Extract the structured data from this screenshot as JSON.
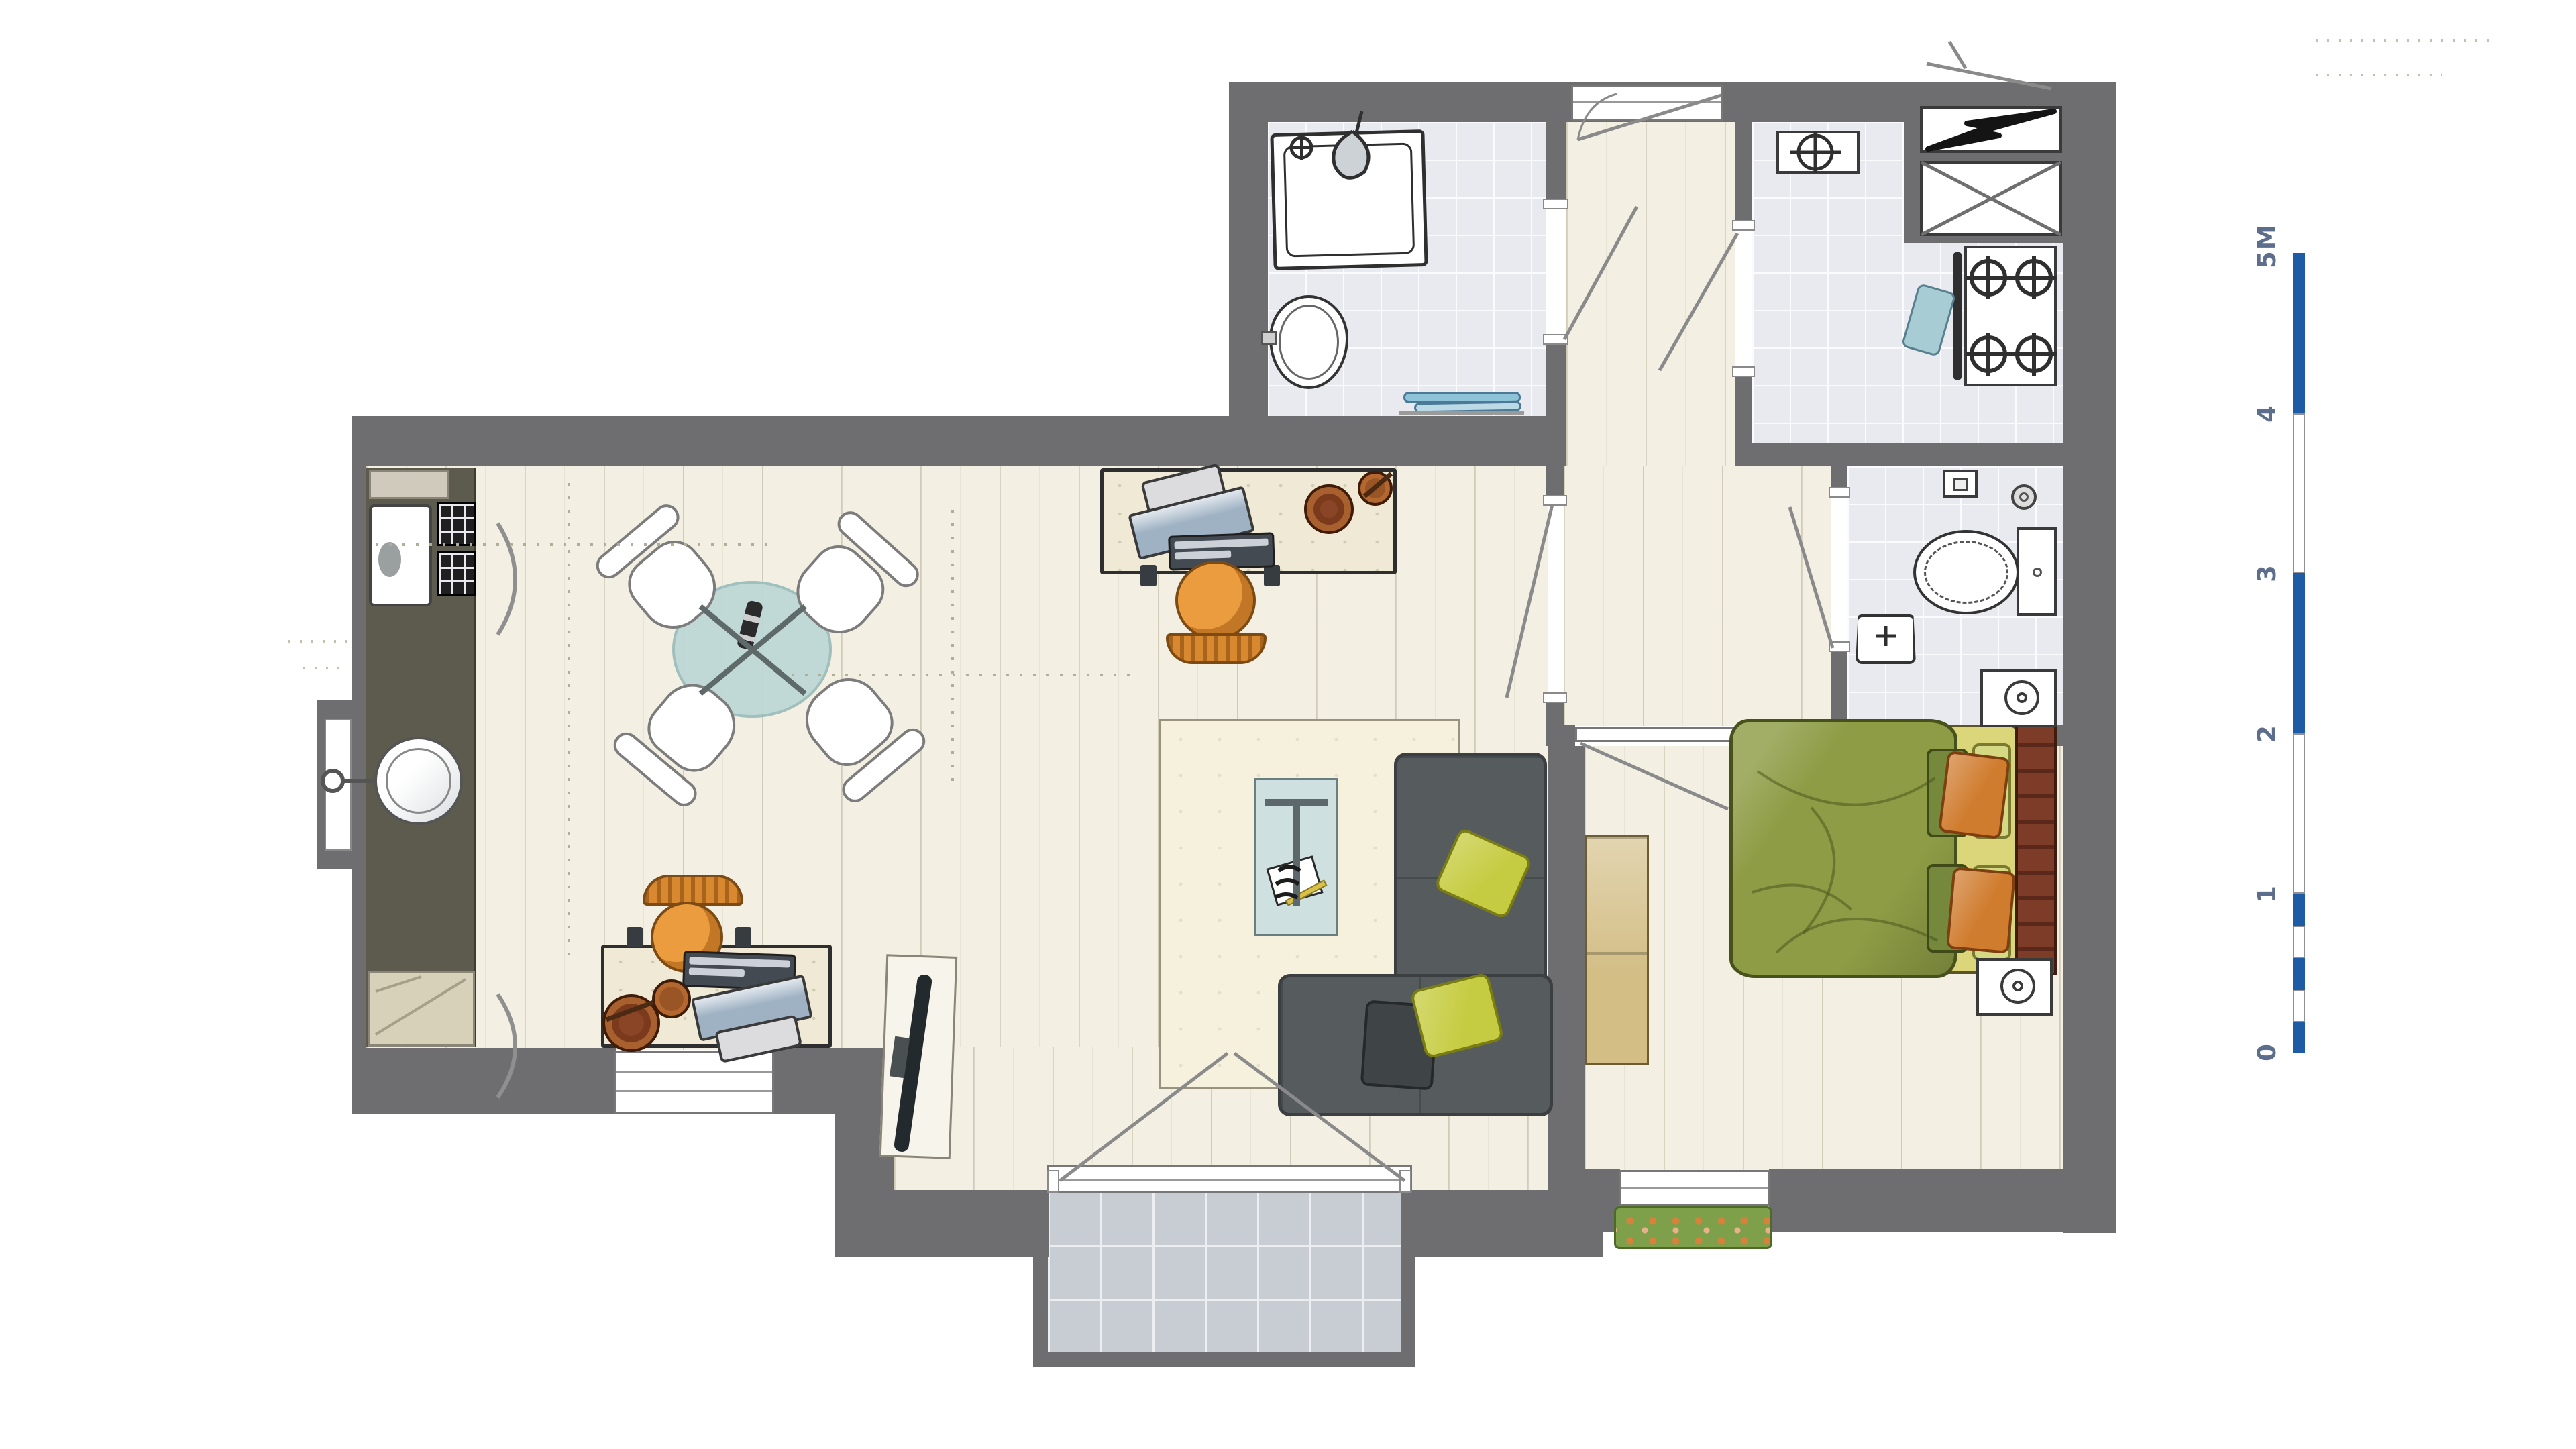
{
  "scale_bar": {
    "unit_labels": [
      "5M",
      "4",
      "3",
      "2",
      "1",
      "0"
    ],
    "bar_color": "#1d5ca5",
    "label_color": "#5d6e8c",
    "total_meters": 5,
    "subdivision": "0 to 1 m divided in 0.2 m alternating segments"
  },
  "palette": {
    "wall": "#6e6e70",
    "wood_floor": "#f3f0e3",
    "tile_floor": "#e9eaef",
    "balcony_tile": "#c8ccd3",
    "kitchen_counter": "#5c5b4d",
    "sofa": "#565b5e",
    "rug": "#f6f1dd",
    "accent_pillow": "#c6cc41",
    "bed_duvet": "#8e9c45",
    "bed_sheet": "#dbd67a",
    "pillow_orange": "#d07c2e",
    "headboard_brick": "#7c3c28",
    "chair_orange": "#eb9c3f",
    "dining_table_glass": "#bcd8d6",
    "towel_teal": "#9fc6d8",
    "flower_box_green": "#7fa04b"
  },
  "icons": {
    "electrical": "lightning-bolt-icon",
    "shaft": "crossed-box-icon",
    "shower": "shower-head-icon",
    "faucet": "faucet-cross-icon",
    "kitchen_sink": "sink-cross-icon",
    "stove": "stove-burner-icon",
    "toilet": "toilet-icon",
    "night_lamp": "lamp-icon",
    "doors": "door-swing-icon",
    "radiator": "radiator-arc-icon"
  }
}
